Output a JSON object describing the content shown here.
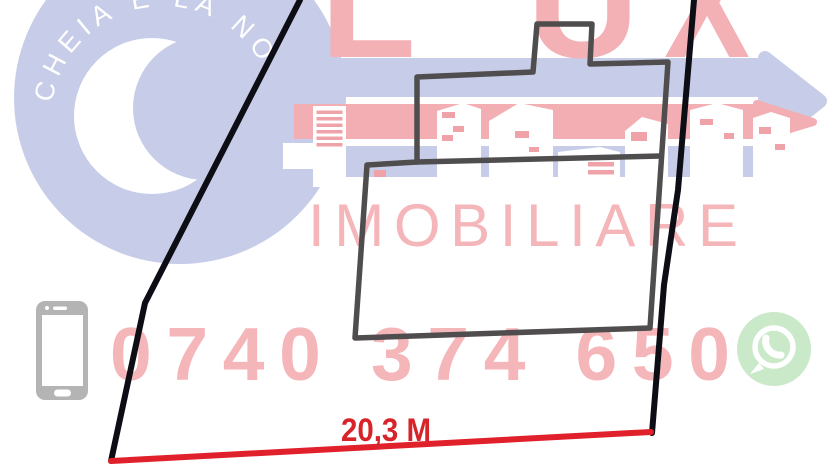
{
  "document": {
    "kind": "land-plot-sketch-photo",
    "description_label": "Watermarked cadastral land plot sketch"
  },
  "watermark": {
    "brand_letters": [
      "L",
      "U",
      "X"
    ],
    "brand_sub": "IMOBILIARE",
    "badge_text": "CHEIA E LA NOI",
    "phone_number": "0740 374 650"
  },
  "measurement": {
    "front_width_label": "20,3 M"
  },
  "icons": {
    "bottom_left": "smartphone-icon",
    "bottom_right": "whatsapp-icon"
  },
  "colors": {
    "boundary-black": "#0d0d15",
    "building-gray": "#4f4d4d",
    "measure-red": "#e0202a",
    "label-red": "#d7232a",
    "wm-pink": "#f2aeb3",
    "wm-pink-text": "#f5b6ba",
    "wm-pink-strong": "#f3b0b5",
    "wm-window-pink": "#efa3a9",
    "wm-blue": "#c7cde8",
    "wa-green": "#c9e9c9",
    "phone-gray": "#b4b4b4",
    "badge-text-white": "#ffffff"
  }
}
